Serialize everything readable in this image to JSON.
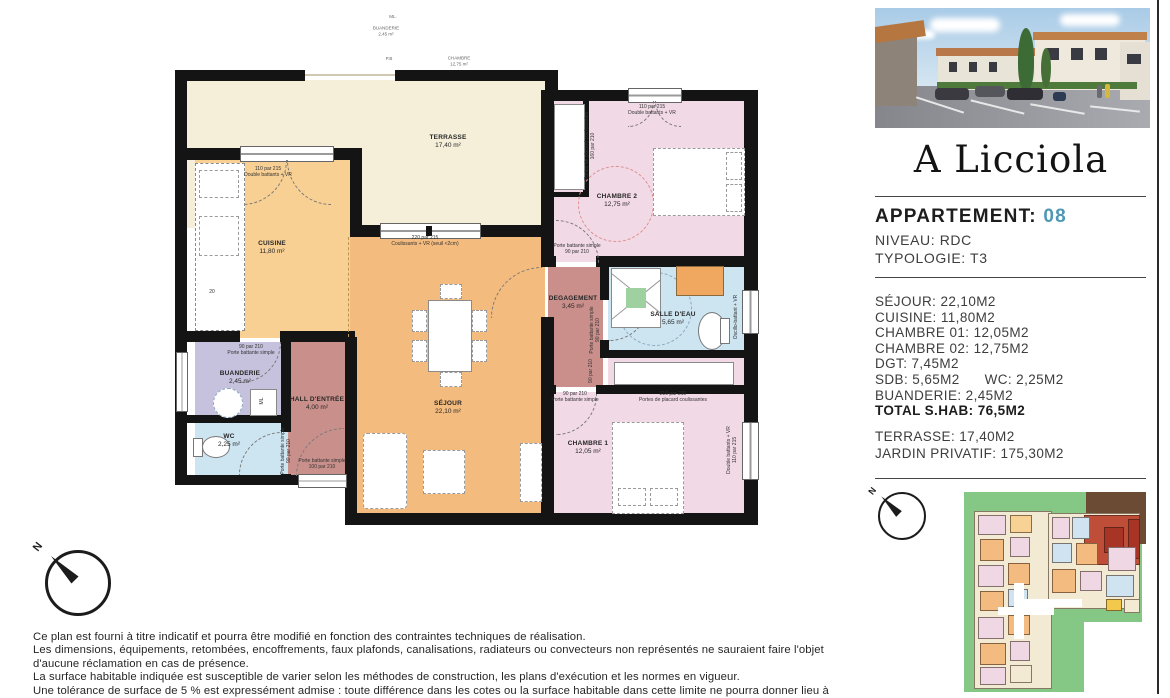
{
  "colors": {
    "accent": "#4e97b5",
    "wall": "#141414",
    "terrasse": "#f5eed8",
    "cuisine": "#f8d094",
    "sejour": "#f4bb7e",
    "chambre": "#f2d9e6",
    "hall": "#c9908b",
    "degagement": "#ca8f8b",
    "buanderie": "#c6c2dd",
    "bath": "#cde4f1",
    "site_green": "#85c785",
    "site_brown": "#6b4b34",
    "site_red": "#bf4e38"
  },
  "panel": {
    "project": "A Licciola",
    "apartment_label": "APPARTEMENT:",
    "apartment_number": "08",
    "niveau": "NIVEAU: RDC",
    "typologie": "TYPOLOGIE: T3",
    "surfaces": [
      "SÉJOUR: 22,10M2",
      "CUISINE: 11,80M2",
      "CHAMBRE 01: 12,05M2",
      "CHAMBRE 02: 12,75M2",
      "DGT: 7,45M2",
      "SDB: 5,65M2      WC: 2,25M2",
      "BUANDERIE: 2,45M2"
    ],
    "total": "TOTAL S.HAB: 76,5M2",
    "exterior": [
      "TERRASSE: 17,40M2",
      "JARDIN PRIVATIF: 175,30M2"
    ],
    "compass_letter": "N"
  },
  "plan": {
    "compass_letter": "N",
    "rooms": [
      {
        "n": "room-terrasse",
        "x": 187,
        "y": 80,
        "w": 360,
        "h": 148,
        "c": "#f5eed8"
      },
      {
        "n": "room-cuisine",
        "x": 195,
        "y": 160,
        "w": 155,
        "h": 178,
        "c": "#f8d094"
      },
      {
        "n": "room-sejour",
        "x": 350,
        "y": 233,
        "w": 195,
        "h": 287,
        "c": "#f4bb7e"
      },
      {
        "n": "room-chambre-2",
        "x": 553,
        "y": 100,
        "w": 192,
        "h": 162,
        "c": "#f2d9e6"
      },
      {
        "n": "room-degagement",
        "x": 548,
        "y": 267,
        "w": 55,
        "h": 120,
        "c": "#ca8f8b"
      },
      {
        "n": "room-salle-deau",
        "x": 608,
        "y": 267,
        "w": 137,
        "h": 88,
        "c": "#cde4f1"
      },
      {
        "n": "room-placard-chambre-1",
        "x": 608,
        "y": 358,
        "w": 137,
        "h": 30,
        "c": "#f2d9e6"
      },
      {
        "n": "room-chambre-1",
        "x": 548,
        "y": 392,
        "w": 197,
        "h": 128,
        "c": "#f2d9e6"
      },
      {
        "n": "room-hall-entree",
        "x": 288,
        "y": 342,
        "w": 62,
        "h": 138,
        "c": "#c9908b"
      },
      {
        "n": "room-buanderie",
        "x": 195,
        "y": 342,
        "w": 93,
        "h": 76,
        "c": "#c6c2dd"
      },
      {
        "n": "room-wc",
        "x": 195,
        "y": 422,
        "w": 93,
        "h": 58,
        "c": "#cde4f1"
      }
    ],
    "labels": [
      {
        "n": "label-terrasse",
        "t": [
          "TERRASSE",
          "17,40 m²"
        ],
        "x": 448,
        "y": 142,
        "c": "room-name"
      },
      {
        "n": "label-cuisine",
        "t": [
          "CUISINE",
          "11,80 m²"
        ],
        "x": 272,
        "y": 248,
        "c": "room-name"
      },
      {
        "n": "label-sejour",
        "t": [
          "SÉJOUR",
          "22,10 m²"
        ],
        "x": 448,
        "y": 408,
        "c": "room-name"
      },
      {
        "n": "label-chambre-2",
        "t": [
          "CHAMBRE 2",
          "12,75 m²"
        ],
        "x": 617,
        "y": 201,
        "c": "room-name"
      },
      {
        "n": "label-degagement",
        "t": [
          "DEGAGEMENT",
          "3,45 m²"
        ],
        "x": 573,
        "y": 303,
        "c": "room-name"
      },
      {
        "n": "label-salle-deau",
        "t": [
          "SALLE D'EAU",
          "5,65 m²"
        ],
        "x": 673,
        "y": 319,
        "c": "room-name"
      },
      {
        "n": "label-chambre-1",
        "t": [
          "CHAMBRE 1",
          "12,05 m²"
        ],
        "x": 588,
        "y": 448,
        "c": "room-name"
      },
      {
        "n": "label-hall-entree",
        "t": [
          "HALL D'ENTRÉE",
          "4,00 m²"
        ],
        "x": 317,
        "y": 404,
        "c": "room-name"
      },
      {
        "n": "label-buanderie",
        "t": [
          "BUANDERIE",
          "2,45 m²"
        ],
        "x": 240,
        "y": 378,
        "c": "room-name"
      },
      {
        "n": "label-wc",
        "t": [
          "WC",
          "2,25 m²"
        ],
        "x": 229,
        "y": 441,
        "c": "room-name"
      },
      {
        "n": "ann-fenetre-cuisine",
        "t": [
          "110 par 215",
          "Double battants + VR"
        ],
        "x": 268,
        "y": 172
      },
      {
        "n": "ann-baie-sejour",
        "t": [
          "220 par 215",
          "Coulissants + VR (seuil <2cm)"
        ],
        "x": 425,
        "y": 241
      },
      {
        "n": "ann-fenetre-chambre-2",
        "t": [
          "110 par 215",
          "Double battants + VR"
        ],
        "x": 652,
        "y": 110
      },
      {
        "n": "ann-porte-buanderie",
        "t": [
          "90 par 210",
          "Porte battante simple"
        ],
        "x": 251,
        "y": 350
      },
      {
        "n": "ann-porte-chambre-2",
        "t": [
          "Porte battante simple",
          "90 par 210"
        ],
        "x": 577,
        "y": 249
      },
      {
        "n": "ann-porte-chambre-1",
        "t": [
          "90 par 210",
          "Porte battante simple"
        ],
        "x": 575,
        "y": 397
      },
      {
        "n": "ann-placard-chambre-1",
        "t": [
          "210 par 210",
          "Portes de placard coulissantes"
        ],
        "x": 673,
        "y": 397
      },
      {
        "n": "ann-porte-entree",
        "t": [
          "Porte battante simple",
          "100 par 210"
        ],
        "x": 322,
        "y": 464
      },
      {
        "n": "ann-placard-chambre-2",
        "t": [
          "Portes de placard coulissantes",
          "160 par 210"
        ],
        "x": 590,
        "y": 146,
        "r": -90
      },
      {
        "n": "ann-porte-wc",
        "t": [
          "Porte battante simple",
          "90 par 210"
        ],
        "x": 286,
        "y": 451,
        "r": -90
      },
      {
        "n": "ann-porte-salle-deau",
        "t": [
          "Porte battante simple",
          "90 par 210"
        ],
        "x": 595,
        "y": 330,
        "r": -90
      },
      {
        "n": "ann-fenetre-chambre-1",
        "t": [
          "Double battants + VR",
          "110 par 215"
        ],
        "x": 732,
        "y": 450,
        "r": -90
      },
      {
        "n": "ann-fenetre-salle-deau",
        "t": [
          "Oscillo-battant + VR"
        ],
        "x": 736,
        "y": 317,
        "r": -90
      },
      {
        "n": "ann-dgt-dim",
        "t": [
          "90 par 210"
        ],
        "x": 591,
        "y": 371,
        "r": -90
      },
      {
        "n": "ann-cuisine-dim",
        "t": [
          "20"
        ],
        "x": 212,
        "y": 292
      },
      {
        "n": "ann-faint-ml",
        "t": [
          "ML."
        ],
        "x": 393,
        "y": 17,
        "c": "faint"
      },
      {
        "n": "ann-faint-buanderie",
        "t": [
          "BUANDERIE",
          "2,45 m²"
        ],
        "x": 386,
        "y": 31,
        "c": "faint"
      },
      {
        "n": "ann-faint-pb",
        "t": [
          "P.B"
        ],
        "x": 389,
        "y": 59,
        "c": "faint"
      },
      {
        "n": "ann-faint-chambre",
        "t": [
          "CHAMBRE",
          "12,75 m²"
        ],
        "x": 459,
        "y": 61,
        "c": "faint"
      },
      {
        "n": "ann-ml-box",
        "t": [
          "ML"
        ],
        "x": 262,
        "y": 401,
        "r": -90
      }
    ]
  },
  "site_plan": {
    "blocks": [
      {
        "x": 6,
        "y": 5,
        "w": 120,
        "h": 200,
        "c": "#85c785"
      },
      {
        "x": 120,
        "y": 5,
        "w": 64,
        "h": 130,
        "c": "#85c785"
      },
      {
        "x": 128,
        "y": 5,
        "w": 60,
        "h": 52,
        "c": "#6b4b34"
      },
      {
        "x": 16,
        "y": 24,
        "w": 78,
        "h": 178,
        "c": "#f3ead3",
        "b": 1
      },
      {
        "x": 90,
        "y": 26,
        "w": 92,
        "h": 96,
        "c": "#f3ead3",
        "b": 1
      },
      {
        "x": 126,
        "y": 28,
        "w": 56,
        "h": 50,
        "c": "#bf4e38",
        "b": 1
      },
      {
        "x": 146,
        "y": 40,
        "w": 20,
        "h": 26,
        "c": "#a83426",
        "b": 1
      },
      {
        "x": 170,
        "y": 32,
        "w": 12,
        "h": 40,
        "c": "#a83426",
        "b": 1
      },
      {
        "x": 20,
        "y": 28,
        "w": 28,
        "h": 20,
        "c": "#f0d7e4",
        "b": 1
      },
      {
        "x": 52,
        "y": 28,
        "w": 22,
        "h": 18,
        "c": "#f8d294",
        "b": 1
      },
      {
        "x": 22,
        "y": 52,
        "w": 24,
        "h": 22,
        "c": "#f3bb80",
        "b": 1
      },
      {
        "x": 52,
        "y": 50,
        "w": 20,
        "h": 20,
        "c": "#f0d7e4",
        "b": 1
      },
      {
        "x": 20,
        "y": 78,
        "w": 26,
        "h": 22,
        "c": "#f0d7e4",
        "b": 1
      },
      {
        "x": 50,
        "y": 76,
        "w": 22,
        "h": 22,
        "c": "#f3bb80",
        "b": 1
      },
      {
        "x": 22,
        "y": 104,
        "w": 24,
        "h": 20,
        "c": "#f3bb80",
        "b": 1
      },
      {
        "x": 50,
        "y": 102,
        "w": 20,
        "h": 18,
        "c": "#cfe4f0",
        "b": 1
      },
      {
        "x": 20,
        "y": 130,
        "w": 26,
        "h": 22,
        "c": "#f0d7e4",
        "b": 1
      },
      {
        "x": 50,
        "y": 128,
        "w": 22,
        "h": 20,
        "c": "#f3bb80",
        "b": 1
      },
      {
        "x": 22,
        "y": 156,
        "w": 26,
        "h": 22,
        "c": "#f3bb80",
        "b": 1
      },
      {
        "x": 52,
        "y": 154,
        "w": 20,
        "h": 20,
        "c": "#f0d7e4",
        "b": 1
      },
      {
        "x": 22,
        "y": 180,
        "w": 26,
        "h": 18,
        "c": "#f0d7e4",
        "b": 1
      },
      {
        "x": 52,
        "y": 178,
        "w": 22,
        "h": 18,
        "c": "#f3ead3",
        "b": 1
      },
      {
        "x": 56,
        "y": 96,
        "w": 10,
        "h": 56,
        "c": "#ffffff"
      },
      {
        "x": 40,
        "y": 120,
        "w": 56,
        "h": 8,
        "c": "#ffffff"
      },
      {
        "x": 64,
        "y": 112,
        "w": 60,
        "h": 8,
        "c": "#ffffff"
      },
      {
        "x": 94,
        "y": 30,
        "w": 18,
        "h": 22,
        "c": "#f0d7e4",
        "b": 1
      },
      {
        "x": 114,
        "y": 30,
        "w": 18,
        "h": 22,
        "c": "#cfe4f0",
        "b": 1
      },
      {
        "x": 94,
        "y": 56,
        "w": 20,
        "h": 20,
        "c": "#cfe4f0",
        "b": 1
      },
      {
        "x": 118,
        "y": 56,
        "w": 22,
        "h": 22,
        "c": "#f3bb80",
        "b": 1
      },
      {
        "x": 94,
        "y": 82,
        "w": 24,
        "h": 24,
        "c": "#f3bb80",
        "b": 1
      },
      {
        "x": 122,
        "y": 84,
        "w": 22,
        "h": 20,
        "c": "#f0d7e4",
        "b": 1
      },
      {
        "x": 150,
        "y": 60,
        "w": 28,
        "h": 24,
        "c": "#f0d7e4",
        "b": 1
      },
      {
        "x": 148,
        "y": 88,
        "w": 28,
        "h": 22,
        "c": "#cfe4f0",
        "b": 1
      },
      {
        "x": 148,
        "y": 112,
        "w": 16,
        "h": 12,
        "c": "#f2c94c",
        "b": 1
      },
      {
        "x": 166,
        "y": 112,
        "w": 16,
        "h": 14,
        "c": "#f3ead3",
        "b": 1
      }
    ]
  },
  "disclaimer": {
    "lines": [
      "Ce plan est fourni à titre indicatif et pourra être modifié en fonction des contraintes techniques de réalisation.",
      "Les dimensions, équipements, retombées, encoffrements, faux plafonds, canalisations, radiateurs ou convecteurs non représentés ne sauraient faire l'objet",
      "d'aucune réclamation en cas de présence.",
      "La surface habitable indiquée est susceptible de varier selon les méthodes de construction, les plans d'exécution et les normes en vigueur.",
      "Une tolérance de surface de 5 % est expressément admise : toute différence dans les cotes ou la surface habitable dans cette limite ne pourra donner lieu à"
    ]
  }
}
